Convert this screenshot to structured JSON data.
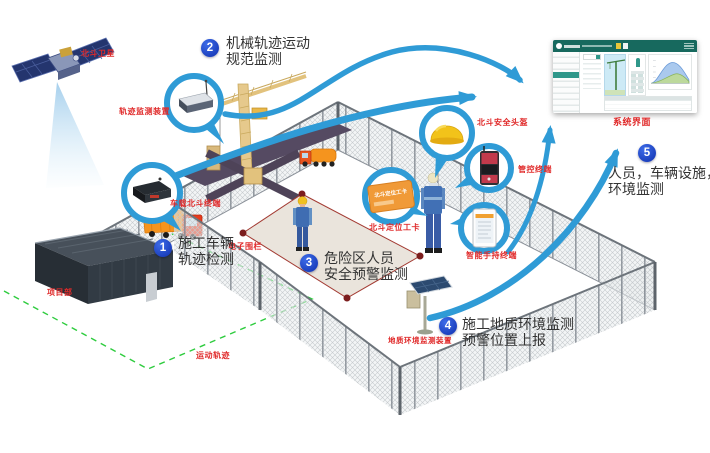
{
  "labels": {
    "satellite": "北斗卫星",
    "track_device": "轨迹监测装置",
    "vehicle_terminal": "车载北斗终端",
    "electronic_fence": "电子围栏",
    "safety_helmet": "北斗安全头盔",
    "control_terminal": "管控终端",
    "positioning_card": "北斗定位工卡",
    "handheld_terminal": "智能手持终端",
    "system_interface": "系统界面",
    "geo_monitor": "地质环境监测装置",
    "project_department": "项目部",
    "movement_track": "运动轨迹",
    "card_face_text": "北斗定位工卡"
  },
  "steps": [
    {
      "num": "1",
      "lines": [
        "施工车辆",
        "轨迹检测"
      ]
    },
    {
      "num": "2",
      "lines": [
        "机械轨迹运动",
        "规范监测"
      ]
    },
    {
      "num": "3",
      "lines": [
        "危险区人员",
        "安全预警监测"
      ]
    },
    {
      "num": "4",
      "lines": [
        "施工地质环境监测",
        "预警位置上报"
      ]
    },
    {
      "num": "5",
      "lines": [
        "人员，车辆设施，",
        "环境监测"
      ]
    }
  ],
  "colors": {
    "arrow_blue": "#2f9bd6",
    "badge_blue": "#1a3cc0",
    "label_red": "#e02a2a",
    "danger_red": "#8a1f1f",
    "trajectory_green": "#2ecc3e",
    "dashboard_teal": "#17695e"
  }
}
